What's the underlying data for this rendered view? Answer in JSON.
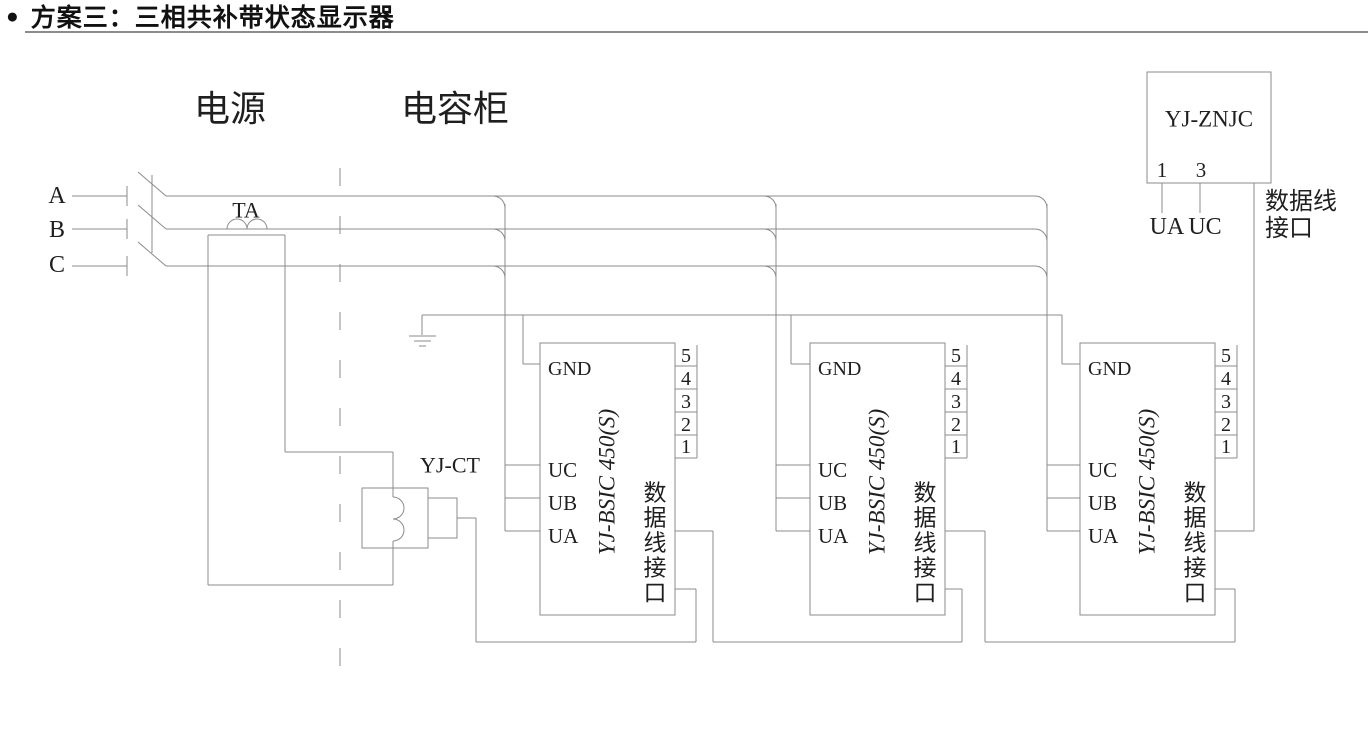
{
  "title": {
    "bullet": "●",
    "text": "方案三：三相共补带状态显示器"
  },
  "sections": {
    "power_label": "电源",
    "cabinet_label": "电容柜"
  },
  "phases": {
    "a": "A",
    "b": "B",
    "c": "C"
  },
  "ta": {
    "label": "TA"
  },
  "ct": {
    "label": "YJ-CT"
  },
  "modules": [
    {
      "name": "YJ-BSIC 450(S)",
      "pin_gnd": "GND",
      "pin_uc": "UC",
      "pin_ub": "UB",
      "pin_ua": "UA",
      "pins_right": [
        "5",
        "4",
        "3",
        "2",
        "1"
      ],
      "interface_chars": [
        "数",
        "据",
        "线",
        "接",
        "口"
      ]
    },
    {
      "name": "YJ-BSIC 450(S)",
      "pin_gnd": "GND",
      "pin_uc": "UC",
      "pin_ub": "UB",
      "pin_ua": "UA",
      "pins_right": [
        "5",
        "4",
        "3",
        "2",
        "1"
      ],
      "interface_chars": [
        "数",
        "据",
        "线",
        "接",
        "口"
      ]
    },
    {
      "name": "YJ-BSIC 450(S)",
      "pin_gnd": "GND",
      "pin_uc": "UC",
      "pin_ub": "UB",
      "pin_ua": "UA",
      "pins_right": [
        "5",
        "4",
        "3",
        "2",
        "1"
      ],
      "interface_chars": [
        "数",
        "据",
        "线",
        "接",
        "口"
      ]
    }
  ],
  "display_unit": {
    "name": "YJ-ZNJC",
    "pin_1": "1",
    "pin_3": "3",
    "label_ua": "UA",
    "label_uc": "UC",
    "interface_line1": "数据线",
    "interface_line2": "接口"
  },
  "colors": {
    "line": "#8b8b8b",
    "text": "#1f1f1f",
    "title": "#111111",
    "rule": "#8c8c8c"
  }
}
